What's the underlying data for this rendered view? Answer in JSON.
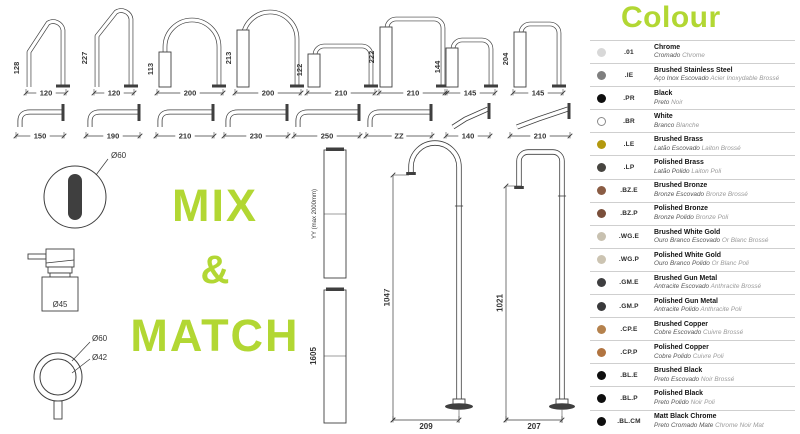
{
  "colors": {
    "accent_green": "#b2d733",
    "line": "#3f3f3f"
  },
  "mix": {
    "line1": "MIX",
    "line2": "&",
    "line3": "MATCH"
  },
  "top_spouts": [
    {
      "type": "slant-neck",
      "height": "128",
      "width": "120"
    },
    {
      "type": "slant-neck",
      "height": "227",
      "width": "120"
    },
    {
      "type": "round-arch",
      "height": "113",
      "width": "200"
    },
    {
      "type": "round-arch",
      "height": "213",
      "width": "200"
    },
    {
      "type": "square-arch",
      "height": "122",
      "width": "210"
    },
    {
      "type": "square-arch",
      "height": "222",
      "width": "210"
    },
    {
      "type": "square-arch",
      "height": "144",
      "width": "145"
    },
    {
      "type": "square-arch",
      "height": "204",
      "width": "145"
    }
  ],
  "wall_spouts": [
    {
      "type": "straight",
      "width": "150"
    },
    {
      "type": "straight",
      "width": "190"
    },
    {
      "type": "straight",
      "width": "210"
    },
    {
      "type": "straight",
      "width": "230"
    },
    {
      "type": "straight",
      "width": "250"
    },
    {
      "type": "straight",
      "width": "ZZ"
    },
    {
      "type": "angled",
      "width": "140"
    },
    {
      "type": "angled",
      "width": "210"
    }
  ],
  "handles": {
    "top_view_diameter": "Ø60",
    "dispenser_diameter": "Ø45",
    "mixer_outer_diameter": "Ø60",
    "mixer_inner_diameter": "Ø42"
  },
  "extension_tubes": [
    {
      "label": "YY (max 2000mm)"
    },
    {
      "label": "1605"
    }
  ],
  "floor_spouts": [
    {
      "type": "round-top",
      "height": "1047",
      "width": "209"
    },
    {
      "type": "square-top",
      "height": "1021",
      "width": "207"
    }
  ],
  "colour_legend": {
    "title": "Colour",
    "entries": [
      {
        "code": ".01",
        "name": "Chrome",
        "pt": "Cromado",
        "fr": "Chrome",
        "swatch": "#d8d8d8",
        "outline": false
      },
      {
        "code": ".IE",
        "name": "Brushed Stainless Steel",
        "pt": "Aço Inox Escovado",
        "fr": "Acier Inoxydable Brossé",
        "swatch": "#7f7f7f",
        "outline": false
      },
      {
        "code": ".PR",
        "name": "Black",
        "pt": "Preto",
        "fr": "Noir",
        "swatch": "#0f0f0f",
        "outline": false
      },
      {
        "code": ".BR",
        "name": "White",
        "pt": "Branco",
        "fr": "Blanche",
        "swatch": "#ffffff",
        "outline": true
      },
      {
        "code": ".LE",
        "name": "Brushed Brass",
        "pt": "Latão Escovado",
        "fr": "Laiton Brossé",
        "swatch": "#b3990f",
        "outline": false
      },
      {
        "code": ".LP",
        "name": "Polished Brass",
        "pt": "Latão Polido",
        "fr": "Laiton Poli",
        "swatch": "#474540",
        "outline": false
      },
      {
        "code": ".BZ.E",
        "name": "Brushed Bronze",
        "pt": "Bronze Escovado",
        "fr": "Bronze Brossé",
        "swatch": "#8a5c44",
        "outline": false
      },
      {
        "code": ".BZ.P",
        "name": "Polished Bronze",
        "pt": "Bronze Polido",
        "fr": "Bronze Poli",
        "swatch": "#7a4f3b",
        "outline": false
      },
      {
        "code": ".WG.E",
        "name": "Brushed White Gold",
        "pt": "Ouro Branco Escovado",
        "fr": "Or Blanc Brossé",
        "swatch": "#c8c1b0",
        "outline": false
      },
      {
        "code": ".WG.P",
        "name": "Polished White Gold",
        "pt": "Ouro Branco Polido",
        "fr": "Or Blanc Poli",
        "swatch": "#ccc4b2",
        "outline": false
      },
      {
        "code": ".GM.E",
        "name": "Brushed Gun Metal",
        "pt": "Antracite Escovado",
        "fr": "Anthracite Brossé",
        "swatch": "#3e3e40",
        "outline": false
      },
      {
        "code": ".GM.P",
        "name": "Polished Gun Metal",
        "pt": "Antracite Polido",
        "fr": "Anthracite Poli",
        "swatch": "#39393b",
        "outline": false
      },
      {
        "code": ".CP.E",
        "name": "Brushed Copper",
        "pt": "Cobre Escovado",
        "fr": "Cuivre Brossé",
        "swatch": "#b5824d",
        "outline": false
      },
      {
        "code": ".CP.P",
        "name": "Polished Copper",
        "pt": "Cobre Polido",
        "fr": "Cuivre Poli",
        "swatch": "#b17440",
        "outline": false
      },
      {
        "code": ".BL.E",
        "name": "Brushed Black",
        "pt": "Preto Escovado",
        "fr": "Noir Brossé",
        "swatch": "#0e0e0e",
        "outline": false
      },
      {
        "code": ".BL.P",
        "name": "Polished Black",
        "pt": "Preto Polido",
        "fr": "Noir Poli",
        "swatch": "#0e0e0e",
        "outline": false
      },
      {
        "code": ".BL.CM",
        "name": "Matt Black Chrome",
        "pt": "Preto Cromado Mate",
        "fr": "Chrome Noir Mat",
        "swatch": "#0e0e0e",
        "outline": false
      }
    ]
  }
}
